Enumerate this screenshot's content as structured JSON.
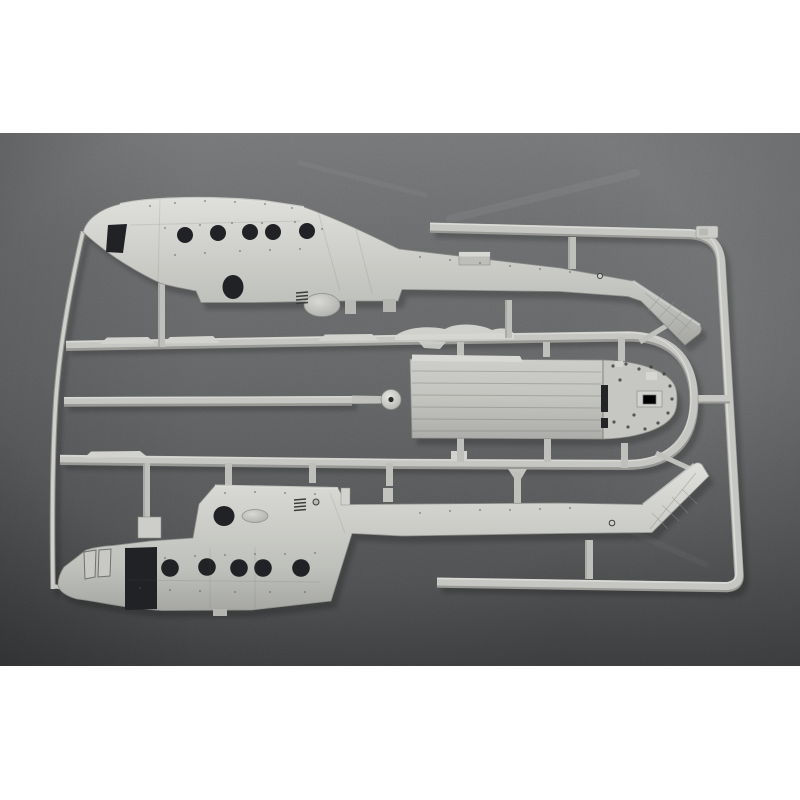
{
  "scene": {
    "type": "product-photograph",
    "subject": "Injection-molded light-gray plastic model kit sprue with two helicopter fuselage halves, a cabin floor panel and runner frame",
    "background": "dark gray felt fabric with vignette, faint scratches",
    "borders": "solid white bands across the top and bottom of the image",
    "window_count_per_fuselage": 5
  },
  "palette": {
    "page_bg": "#ffffff",
    "photo_top": "#787a7b",
    "photo_mid": "#656768",
    "photo_bottom": "#424445",
    "plastic": "#c6c7c2",
    "plastic_light": "#dfdfdb",
    "plastic_dark": "#999a96",
    "hole_dark": "#212225",
    "shadow": "rgba(0,0,0,0.20)"
  },
  "parts": [
    {
      "id": "upper-fuselage-half",
      "label": "Helicopter fuselage half, nose left, tail boom bending down-right into hatched tail fin"
    },
    {
      "id": "lower-fuselage-half",
      "label": "Mirrored helicopter fuselage half below, tail fin angling up-right"
    },
    {
      "id": "floor-panel",
      "label": "Cabin floor panel with riveted D-shaped tail deck, dark slots and raised box"
    },
    {
      "id": "sprue-frame",
      "label": "Outer runner frame: top bar, rounded corner, right vertical bar, bottom bar"
    },
    {
      "id": "hairpin-runner",
      "label": "Inner U-shaped runner loop wrapping the floor panel's tail deck"
    },
    {
      "id": "center-runner",
      "label": "Central runner ending in a round injection-gate boss with dark center"
    },
    {
      "id": "left-runner",
      "label": "Thin bowed runner joining both fuselage nose tips"
    },
    {
      "id": "sprue-letter-tag",
      "label": "Small embossed letter tag on the top bar near the corner"
    }
  ]
}
